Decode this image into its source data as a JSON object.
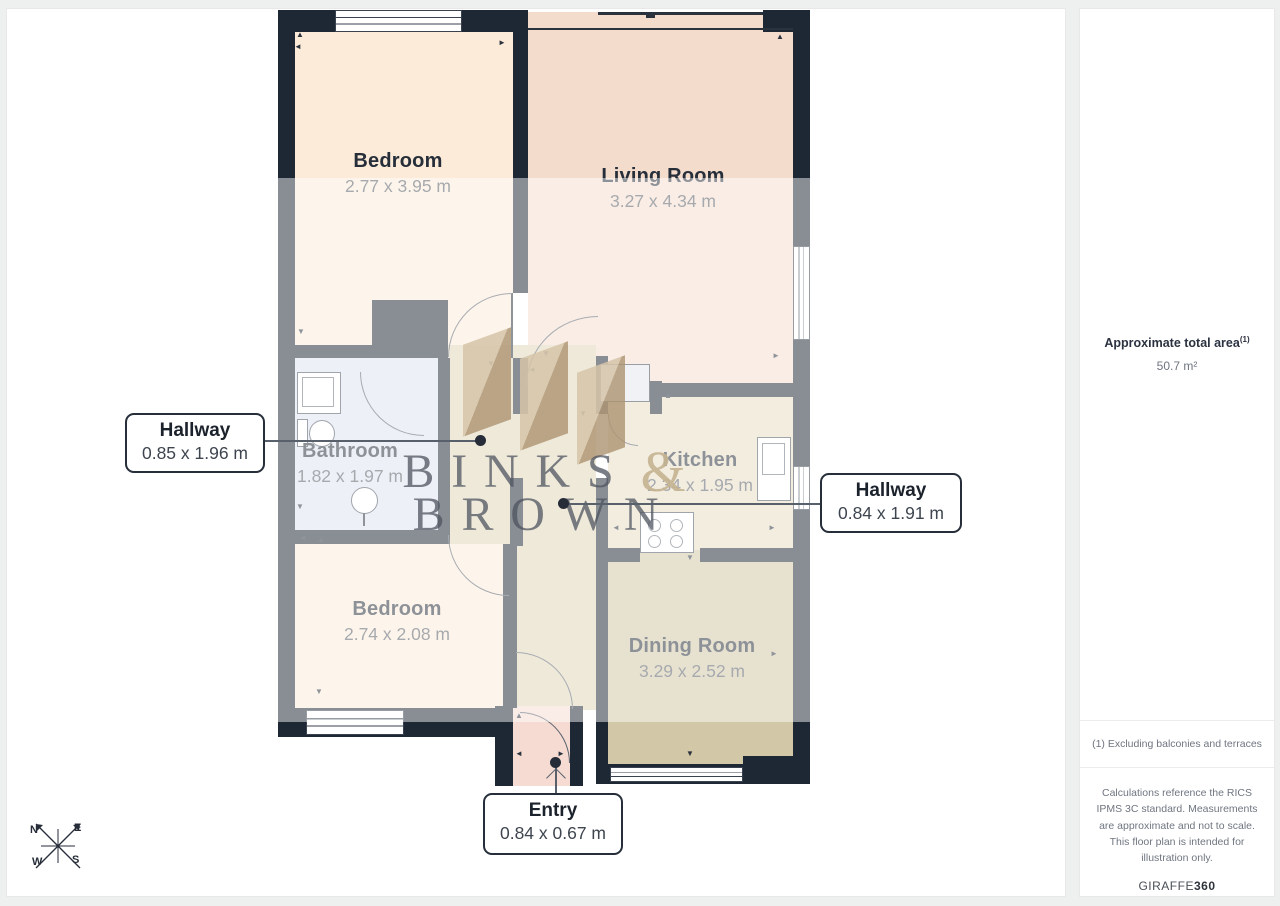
{
  "floorplan": {
    "rooms": [
      {
        "name": "Bedroom",
        "dims": "2.77 x 3.95 m"
      },
      {
        "name": "Living Room",
        "dims": "3.27 x 4.34 m"
      },
      {
        "name": "Bathroom",
        "dims": "1.82 x 1.97 m"
      },
      {
        "name": "Kitchen",
        "dims": "2.34 x 1.95 m"
      },
      {
        "name": "Bedroom",
        "dims": "2.74 x 2.08 m"
      },
      {
        "name": "Dining Room",
        "dims": "3.29 x 2.52 m"
      }
    ],
    "callouts": [
      {
        "title": "Hallway",
        "dims": "0.85 x 1.96 m"
      },
      {
        "title": "Hallway",
        "dims": "0.84 x 1.91 m"
      },
      {
        "title": "Entry",
        "dims": "0.84 x 0.67 m"
      }
    ],
    "compass": {
      "n": "N",
      "e": "E",
      "s": "S",
      "w": "W"
    },
    "tick_glyphs": {
      "up": "▲",
      "down": "▼",
      "left": "◄",
      "right": "►"
    },
    "colors": {
      "wall": "#1e2834",
      "bedroom": "#fcebd8",
      "living": "#f4dccd",
      "bathroom": "#dde2ee",
      "kitchen": "#e9dcc4",
      "dining": "#d2c7a6",
      "hallway": "#e0d5b8",
      "entry": "#f5dbd1",
      "watermark_tan": "#cdb997"
    }
  },
  "watermark": {
    "line1": "BINKS",
    "amp": "&",
    "line2": "BROWN"
  },
  "sidebar": {
    "area_label": "Approximate total area",
    "area_superscript": "(1)",
    "area_value": "50.7 m²",
    "footnote": "(1) Excluding balconies and terraces",
    "disclaimer": "Calculations reference the RICS IPMS 3C standard. Measurements are approximate and not to scale. This floor plan is intended for illustration only.",
    "brand_regular": "GIRAFFE",
    "brand_bold": "360"
  }
}
